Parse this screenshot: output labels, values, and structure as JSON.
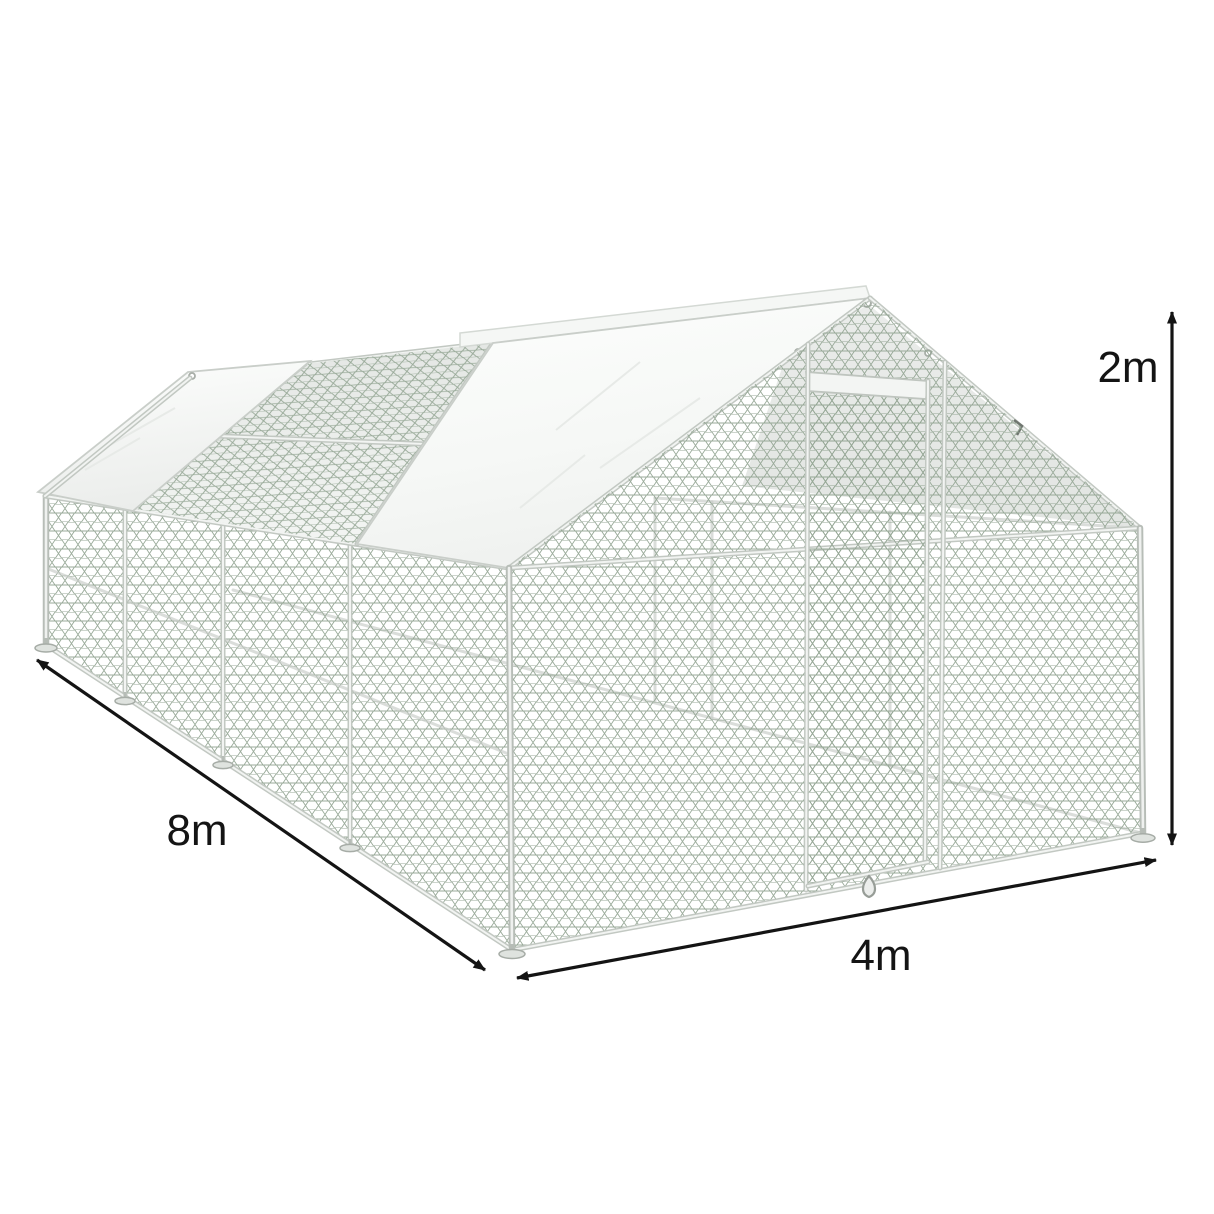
{
  "image": {
    "kind": "product-dimension-illustration",
    "subject": "Galvanized walk-in chicken run cage with hexagonal wire mesh, white roof tarps and front mesh door",
    "background": "#ffffff"
  },
  "annotations": {
    "arrow_color": "#141414",
    "dimensions": [
      {
        "id": "length",
        "label": "8m",
        "value": 8,
        "unit": "m",
        "along": "left side wall base"
      },
      {
        "id": "width",
        "label": "4m",
        "value": 4,
        "unit": "m",
        "along": "front base edge"
      },
      {
        "id": "height",
        "label": "2m",
        "value": 2,
        "unit": "m",
        "along": "right vertical edge"
      }
    ]
  },
  "palette": {
    "frame": "#c2c8c2",
    "frame_highlight": "#f2f4f2",
    "mesh_wire": "#93a593",
    "tarp_white": "#fbfcfb",
    "tarp_shade": "#ededed",
    "see_through_shade": "#e7eae7",
    "annotation": "#141414"
  }
}
